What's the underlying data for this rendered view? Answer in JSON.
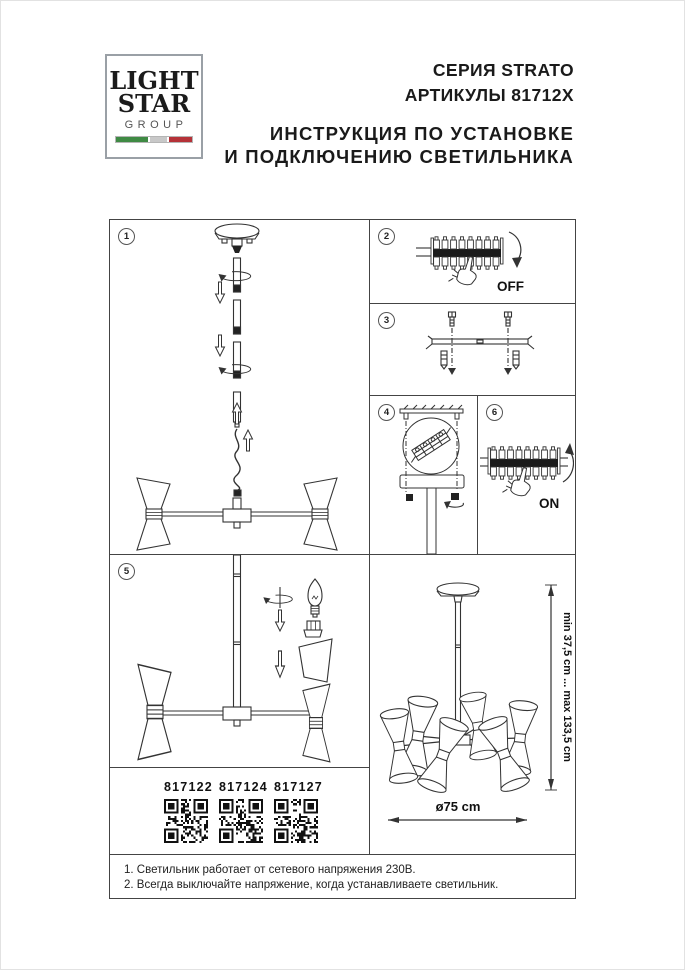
{
  "header": {
    "logo": {
      "line1": "LIGHT",
      "line2": "STAR",
      "line3": "GROUP"
    },
    "series": "СЕРИЯ STRATO",
    "articles": "АРТИКУЛЫ 81712X",
    "title_line1": "ИНСТРУКЦИЯ ПО УСТАНОВКЕ",
    "title_line2": "И ПОДКЛЮЧЕНИЮ СВЕТИЛЬНИКА"
  },
  "colors": {
    "line": "#333333",
    "flag_green": "#3f8a44",
    "flag_silver": "#c8c8c8",
    "flag_red": "#b53238"
  },
  "panels": {
    "p1": {
      "number": "1"
    },
    "p2": {
      "number": "2",
      "label": "OFF"
    },
    "p3": {
      "number": "3"
    },
    "p4": {
      "number": "4"
    },
    "p5": {
      "number": "5"
    },
    "p6": {
      "number": "6",
      "label": "ON"
    }
  },
  "qr_codes": [
    {
      "code": "817122"
    },
    {
      "code": "817124"
    },
    {
      "code": "817127"
    }
  ],
  "dimensions": {
    "height_label": "min 37,5 cm ... max 133,5 cm",
    "diameter_label": "ø75 cm"
  },
  "notes": {
    "line1": "1. Светильник работает от сетевого напряжения 230В.",
    "line2": "2. Всегда выключайте напряжение, когда устанавливаете светильник."
  }
}
